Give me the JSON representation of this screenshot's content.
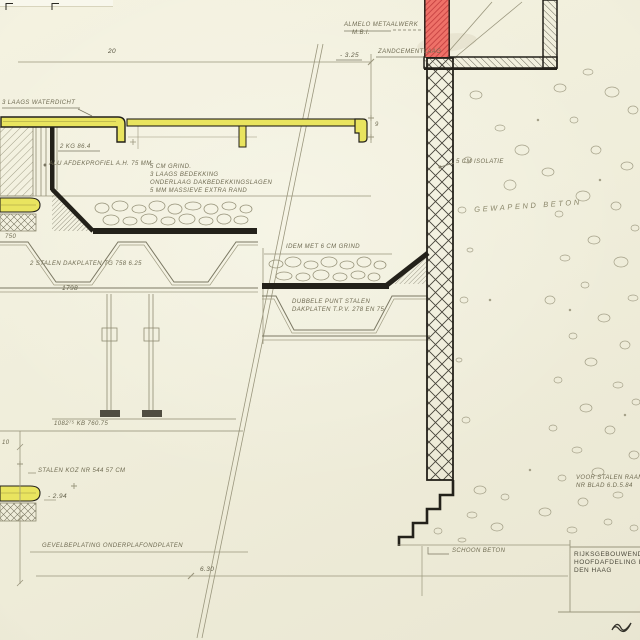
{
  "sheet": {
    "kind": "architectural construction detail drawing",
    "colors": {
      "paper": "#f0eedb",
      "ink": "#23211a",
      "pencil": "#8f8b72",
      "highlight_yellow": "#e9e45f",
      "highlight_red": "#ee6f66",
      "red_hatch": "#c43f3f",
      "text": "#6f6b52"
    }
  },
  "labels": {
    "top": {
      "dim_20": "20",
      "dim_9": "9",
      "metalwork1": "ALMELO METAALWERK",
      "metalwork2": "M.B.I.",
      "level": "- 3.25",
      "cement": "ZANDCEMENTLAAG"
    },
    "parapet": {
      "waterproof": "3 LAAGS WATERDICHT",
      "kg_ref": "2 KG 86.4",
      "alu_profile": "ALU AFDEKPROFIEL A.H. 75 MM",
      "spec1": "5 CM GRIND.",
      "spec2": "3 LAAGS BEDEKKING",
      "spec3": "ONDERLAAG DAKBEDEKKINGSLAGEN",
      "spec4": "5 MM MASSIEVE EXTRA RAND",
      "dim_750": "750"
    },
    "roof_left": {
      "deck": "2 STALEN DAKPLATEN TG 758 6.25",
      "dim_1798": "1798"
    },
    "roof_right": {
      "gravel": "IDEM MET 6 CM GRIND",
      "deck1": "DUBBELE PUNT STALEN",
      "deck2": "DAKPLATEN T.P.V. 278 EN 75"
    },
    "wall_right": {
      "insulation": "5 CM ISOLATIE",
      "concrete": "GEWAPEND BETON",
      "window1": "VOOR STALEN RAAM",
      "window2": "NR BLAD 6.D.5.84",
      "fairfaced": "SCHOON BETON"
    },
    "bottom_left": {
      "hanger_dim": "1082⁷⁵  KB 760.75",
      "dim_10": "10",
      "frame": "STALEN KOZ NR 544 57 CM",
      "level": "- 2.94",
      "facade": "GEVELBEPLATING ONDERPLAFONDPLATEN",
      "dim_630": "6.30"
    },
    "title_block": {
      "line1": "RIJKSGEBOUWENDI",
      "line2": "HOOFDAFDELING B",
      "line3": "DEN HAAG"
    }
  }
}
